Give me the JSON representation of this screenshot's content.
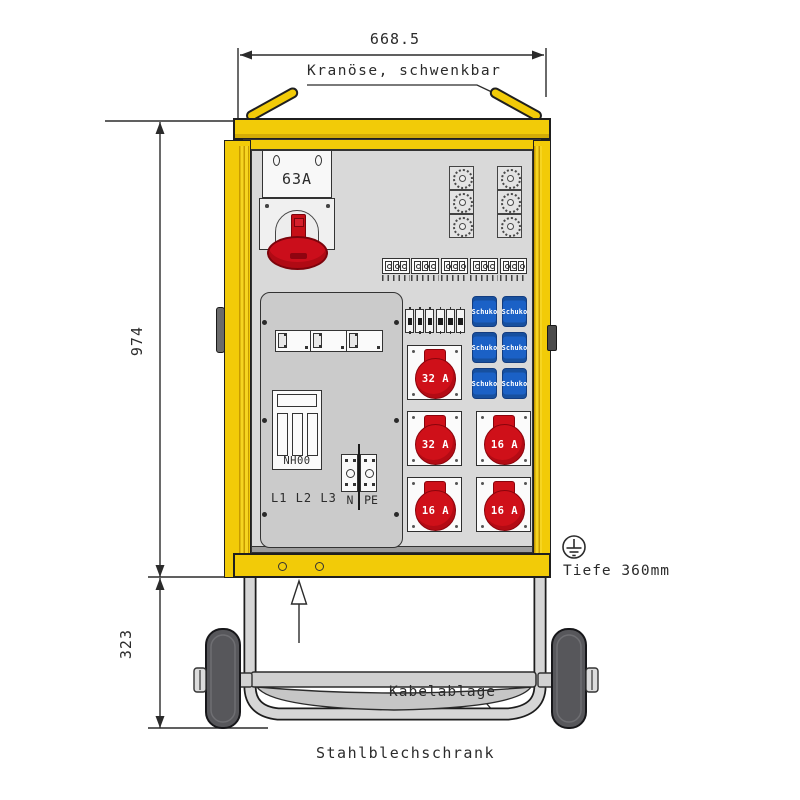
{
  "dimensions": {
    "width_top": "668.5",
    "height_main": "974",
    "height_base": "323",
    "depth_label": "Tiefe 360mm"
  },
  "annotations": {
    "crane_label": "Kranöse, schwenkbar",
    "cable_tray_label": "Kabelablage",
    "cabinet_type_label": "Stahlblechschrank"
  },
  "components": {
    "main_breaker_label": "63A",
    "nh_fuse_label": "NH00",
    "phases_label": "L1 L2 L3",
    "neutral_label": "N",
    "pe_label": "PE",
    "schuko_label": "Schuko",
    "schuko_count": 6,
    "cee_sockets": [
      "32 A",
      "32 A",
      "16 A",
      "16 A",
      "16 A"
    ]
  },
  "colors": {
    "cabinet_yellow": "#F2CB08",
    "schuko_blue": "#1B61C6",
    "cee_red": "#CF1019",
    "panel_gray": "#D9D9D9"
  }
}
